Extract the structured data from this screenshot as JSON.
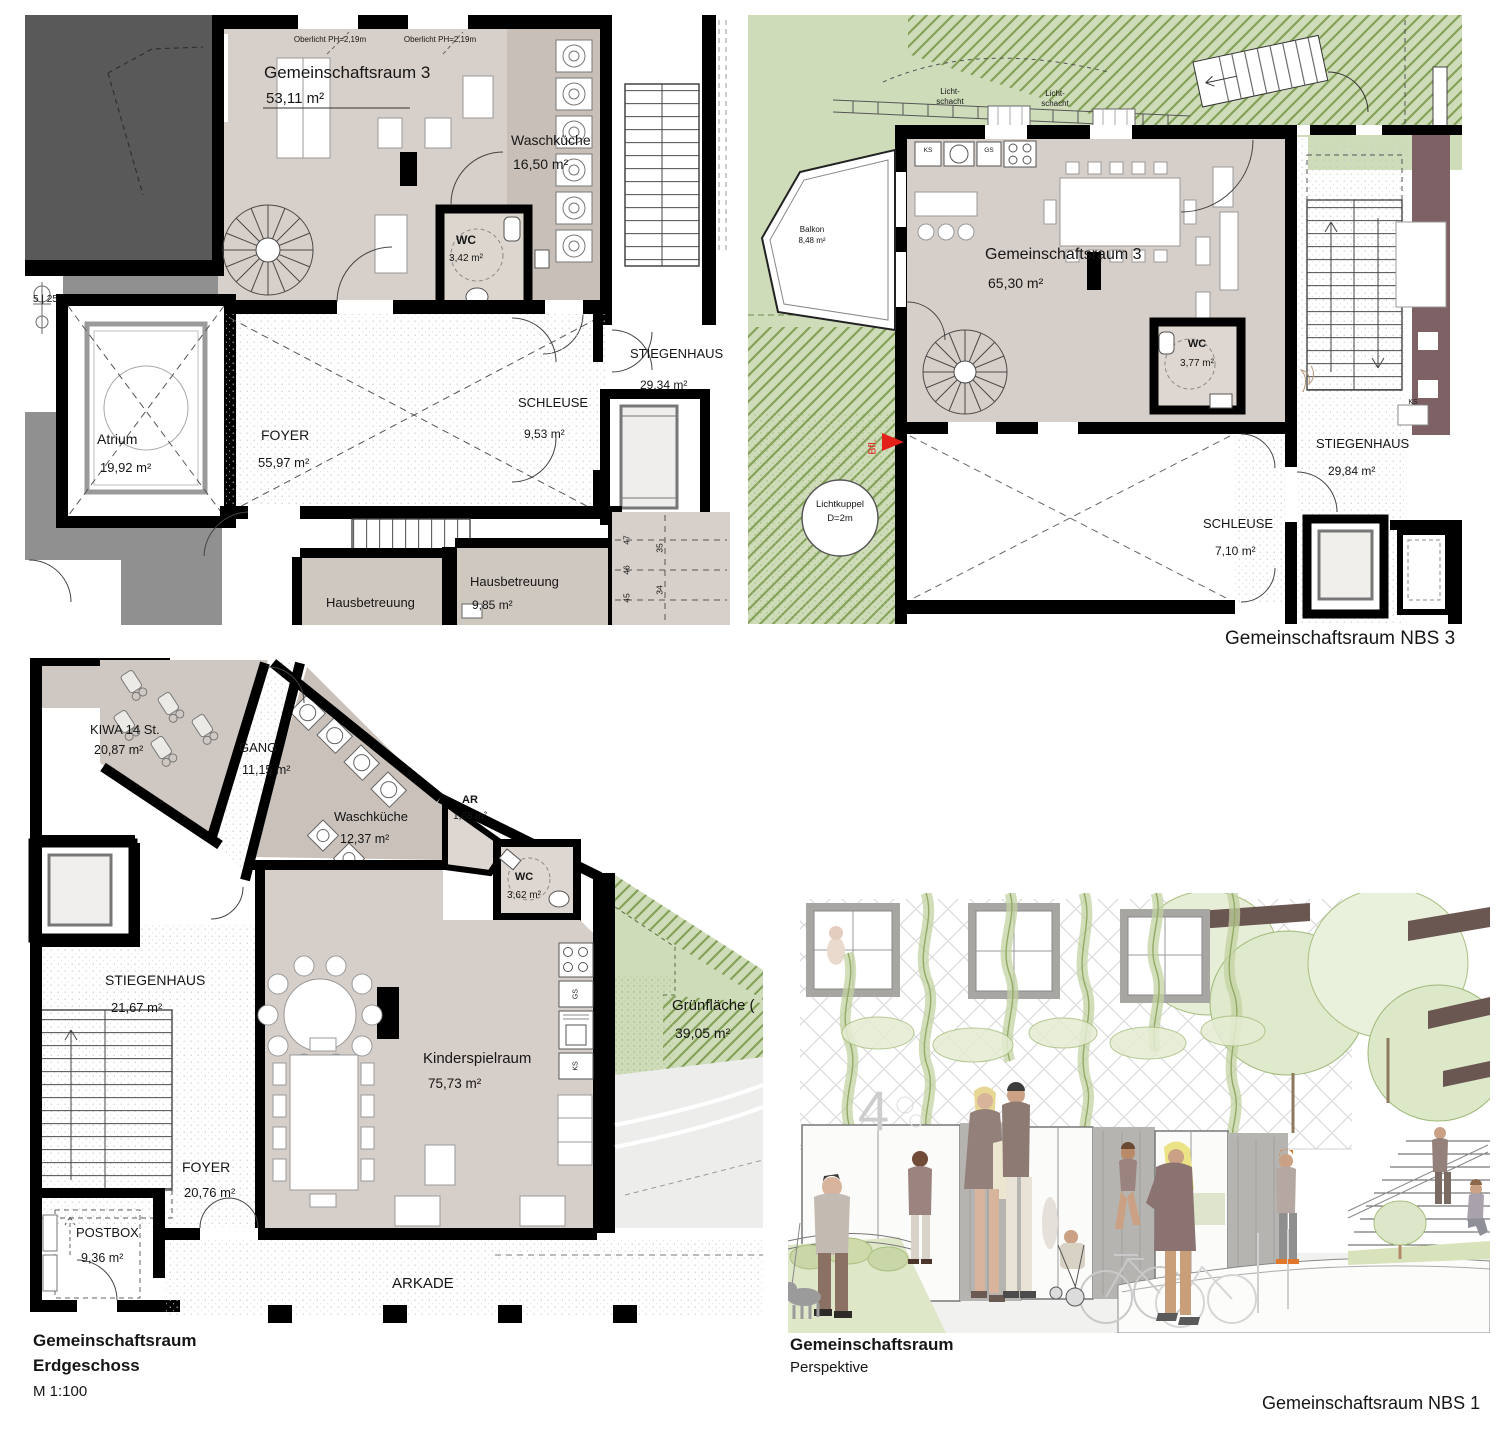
{
  "colors": {
    "wall": "#000000",
    "room_fill": "#d7cfc9",
    "room_fill_dark": "#c8c0b8",
    "green": "#cfdcba",
    "maroon": "#7d6164",
    "accent_red": "#e3211a"
  },
  "plan1": {
    "oberlicht_left": "Oberlicht PH=2,19m",
    "oberlicht_right": "Oberlicht PH=2,19m",
    "gemeinschaftsraum": {
      "name": "Gemeinschaftsraum 3",
      "area": "53,11 m²"
    },
    "waschkueche": {
      "name": "Waschküche",
      "area": "16,50 m²"
    },
    "wc": {
      "name": "WC",
      "area": "3,42 m²"
    },
    "atrium": {
      "name": "Atrium",
      "area": "19,92 m²"
    },
    "foyer": {
      "name": "FOYER",
      "area": "55,97 m²"
    },
    "schleuse": {
      "name": "SCHLEUSE",
      "area": "9,53 m²"
    },
    "stiegenhaus": {
      "name": "STIEGENHAUS",
      "area": "29,34 m²"
    },
    "hausbetreuung_left": "Hausbetreuung",
    "hausbetreuung_right": {
      "name": "Hausbetreuung",
      "area": "9,85 m²"
    },
    "tree_tag": "5 | 25",
    "parking": [
      "47",
      "46",
      "45",
      "35",
      "34"
    ]
  },
  "plan2": {
    "caption": "Gemeinschaftsraum NBS 3",
    "lichtschacht": {
      "line1": "Licht-",
      "line2": "schacht"
    },
    "gemeinschaftsraum": {
      "name": "Gemeinschaftsraum 3",
      "area": "65,30 m²"
    },
    "wc": {
      "name": "WC",
      "area": "3,77 m²"
    },
    "stiegenhaus": {
      "name": "STIEGENHAUS",
      "area": "29,84 m²"
    },
    "schleuse": {
      "name": "SCHLEUSE",
      "area": "7,10 m²"
    },
    "balkon": {
      "name": "Balkon",
      "area": "8,48 m²"
    },
    "lichtkuppel": {
      "line1": "Lichtkuppel",
      "line2": "D=2m"
    },
    "bfl": "Bfl.",
    "ks": "KS",
    "gs": "GS",
    "ks_right": "KS"
  },
  "plan3": {
    "caption": {
      "line1": "Gemeinschaftsraum",
      "line2": "Erdgeschoss",
      "line3": "M 1:100"
    },
    "kiwa": {
      "name": "KIWA 14 St.",
      "area": "20,87 m²"
    },
    "gang": {
      "name": "GANG",
      "area": "11,15 m²"
    },
    "waschkueche": {
      "name": "Waschküche",
      "area": "12,37 m²"
    },
    "ar": {
      "name": "AR",
      "area": "1,68 m²"
    },
    "wc": {
      "name": "WC",
      "area": "3,62 m²"
    },
    "stiegenhaus": {
      "name": "STIEGENHAUS",
      "area": "21,67 m²"
    },
    "kinderspielraum": {
      "name": "Kinderspielraum",
      "area": "75,73 m²"
    },
    "foyer": {
      "name": "FOYER",
      "area": "20,76 m²"
    },
    "postbox": {
      "name": "POSTBOX",
      "area": "9,36 m²"
    },
    "arkade": "ARKADE",
    "gruenflaeche": {
      "name": "Grünfläche (",
      "area": "39,05 m²"
    },
    "gs": "GS",
    "ks": "KS"
  },
  "perspective": {
    "caption": {
      "line1": "Gemeinschaftsraum",
      "line2": "Perspektive"
    },
    "door_number": "4"
  },
  "footer": "Gemeinschaftsraum NBS 1"
}
